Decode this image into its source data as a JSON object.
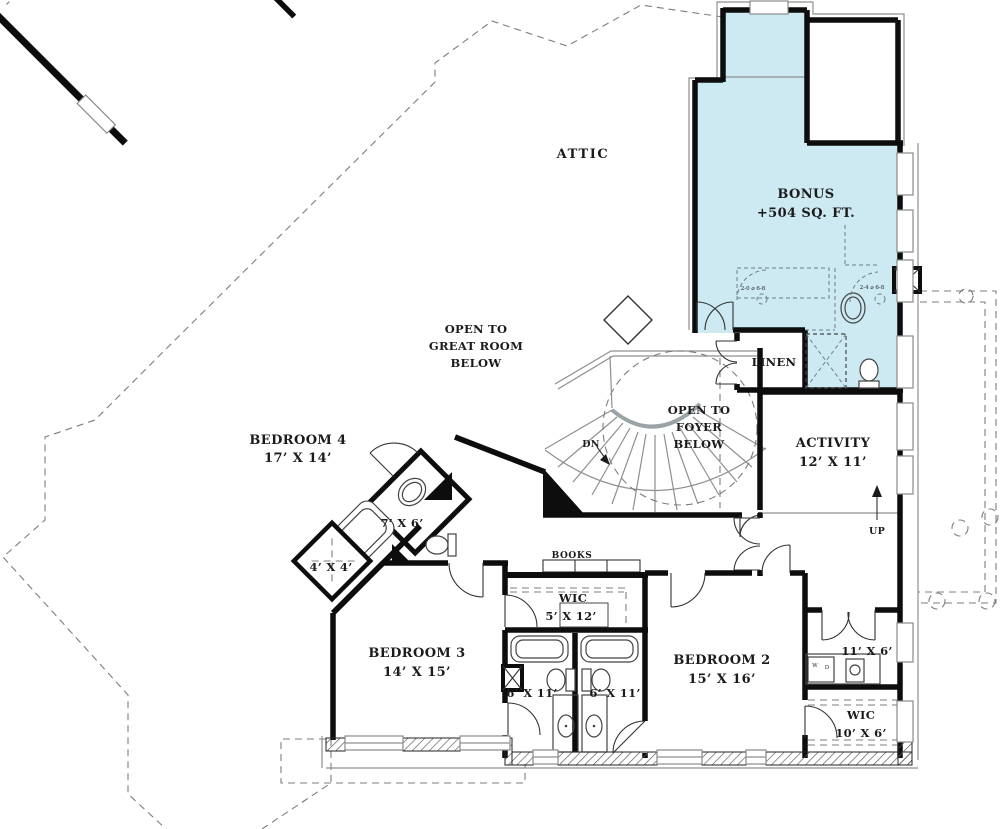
{
  "plan_title": "Second Floor Plan",
  "colors": {
    "bonus_fill": "#cdeaf3",
    "wall": "#0d0d0d",
    "line_gray": "#8f8f8f"
  },
  "rooms": {
    "attic": {
      "name": "ATTIC"
    },
    "bonus": {
      "name": "BONUS",
      "area": "+504 SQ. FT."
    },
    "open_great": {
      "l1": "OPEN TO",
      "l2": "GREAT ROOM",
      "l3": "BELOW"
    },
    "bedroom4": {
      "name": "BEDROOM 4",
      "dims": "17’ X 14’"
    },
    "open_foyer": {
      "l1": "OPEN TO",
      "l2": "FOYER",
      "l3": "BELOW"
    },
    "activity": {
      "name": "ACTIVITY",
      "dims": "12’ X 11’"
    },
    "linen": {
      "name": "LINEN"
    },
    "bath_hall": {
      "dims": "7’ X 6’"
    },
    "closet44": {
      "dims": "4’ X 4’"
    },
    "books": {
      "name": "BOOKS"
    },
    "wic1": {
      "name": "WIC",
      "dims": "5’ X 12’"
    },
    "bedroom3": {
      "name": "BEDROOM 3",
      "dims": "14’ X 15’"
    },
    "bath_left": {
      "dims": "6’ X 11’"
    },
    "bath_right": {
      "dims": "6’ X 11’"
    },
    "bedroom2": {
      "name": "BEDROOM 2",
      "dims": "15’ X 16’"
    },
    "laundry": {
      "dims": "11’ X 6’"
    },
    "wic2": {
      "name": "WIC",
      "dims": "10’ X 6’"
    }
  },
  "stairs": {
    "down": "DN",
    "up": "UP"
  },
  "callouts": {
    "door_a": "2-0 ⌀ 6-8",
    "door_b": "2-4 ⌀ 6-8",
    "washer": "W",
    "dryer": "D"
  }
}
